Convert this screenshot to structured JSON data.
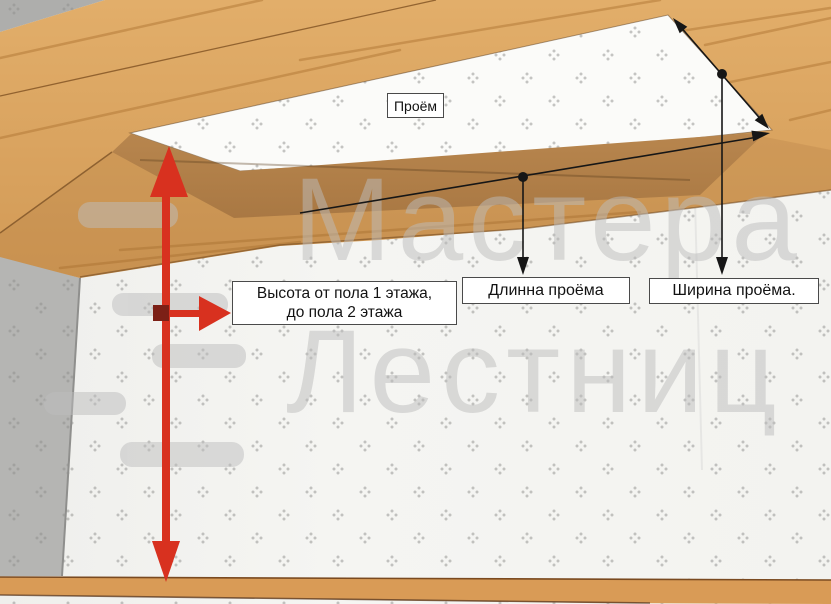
{
  "labels": {
    "opening": "Проём",
    "height_line1": "Высота от пола 1 этажа,",
    "height_line2": "до пола 2 этажа",
    "length": "Длинна проёма",
    "width": "Ширина проёма."
  },
  "watermark": {
    "line1": "Мастера",
    "line2": "Лестниц"
  },
  "colors": {
    "arrow_red": "#d8311f",
    "arrow_red_dark": "#7c2016",
    "dimension_black": "#161616",
    "wood_light": "#ddaa66",
    "wood_dark_face": "#b2814a",
    "floor_wood": "#d99b56",
    "wall_gray": "#b5b5b3",
    "wall_light": "#f4f4f1",
    "ceiling_white": "#fbfbf9",
    "watermark_gray": "#bdbdbd"
  }
}
